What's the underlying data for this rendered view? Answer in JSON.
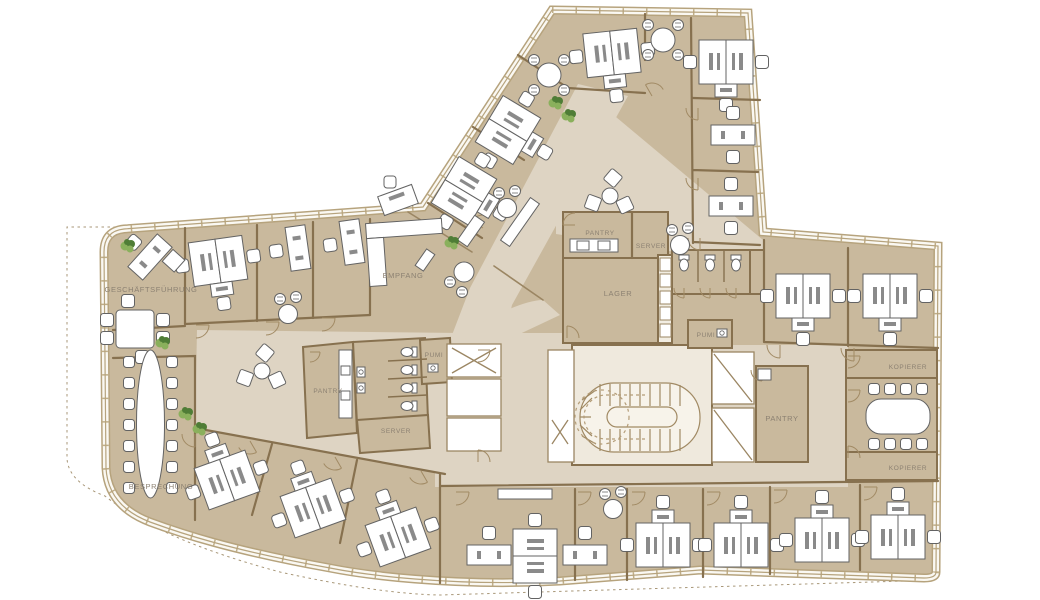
{
  "floorplan": {
    "kind": "office-floor-plan",
    "labels": [
      {
        "id": "geschaeftsfuehrung",
        "text": "GESCHÄFTSFÜHRUNG"
      },
      {
        "id": "empfang",
        "text": "EMPFANG"
      },
      {
        "id": "besprechung",
        "text": "BESPRECHUNG"
      },
      {
        "id": "pantry-lower",
        "text": "PANTRY"
      },
      {
        "id": "server-lower",
        "text": "SERVER"
      },
      {
        "id": "pumi-lower",
        "text": "PUMI"
      },
      {
        "id": "pantry-upper",
        "text": "PANTRY"
      },
      {
        "id": "server-upper",
        "text": "SERVER"
      },
      {
        "id": "lager",
        "text": "LAGER"
      },
      {
        "id": "pumi-upper",
        "text": "PUMI"
      },
      {
        "id": "pantry-right",
        "text": "PANTRY"
      },
      {
        "id": "kopierer-top",
        "text": "KOPIERER"
      },
      {
        "id": "kopierer-bottom",
        "text": "KOPIERER"
      }
    ],
    "colors": {
      "room": "#c9b99d",
      "corridor": "#ded4c3",
      "stair_area": "#efe9dd",
      "wall": "#87714f",
      "wall_light": "#a18a64",
      "facade": "#b6a37d",
      "facade_fill": "#faf8f2",
      "furniture_fill": "#ffffff",
      "furniture_stroke": "#636363",
      "monitor": "#8a8a8a",
      "plant_dark": "#4f7d36",
      "plant_light": "#8ab05c",
      "label_text": "#8c8172",
      "site_dash": "#a89778"
    }
  }
}
